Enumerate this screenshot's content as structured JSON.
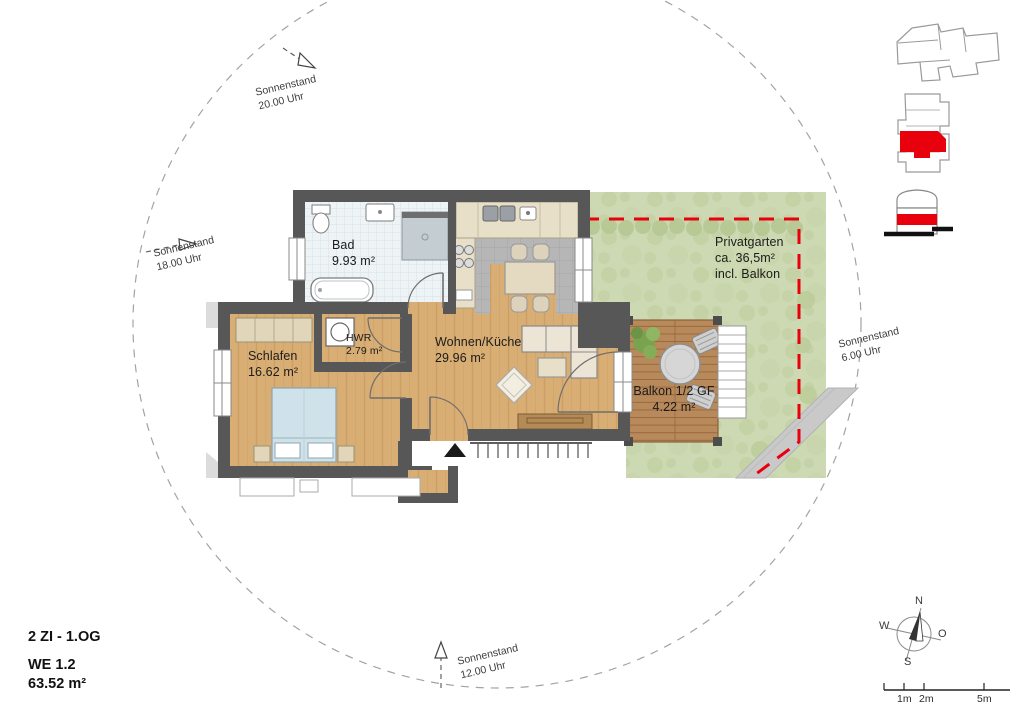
{
  "title_block": {
    "type_line": "2 ZI - 1.OG",
    "unit_line": "WE 1.2",
    "area_line": "63.52 m²"
  },
  "rooms": {
    "bad": {
      "name": "Bad",
      "area": "9.93 m²"
    },
    "schlafen": {
      "name": "Schlafen",
      "area": "16.62 m²"
    },
    "hwr": {
      "name": "HWR",
      "area": "2.79 m²"
    },
    "wohnen": {
      "name": "Wohnen/Küche",
      "area": "29.96 m²"
    },
    "balkon": {
      "name": "Balkon 1/2 GF",
      "area": "4.22 m²"
    },
    "privatgarten": {
      "name": "Privatgarten",
      "area": "ca. 36,5m²",
      "note": "incl. Balkon"
    }
  },
  "sun_positions": {
    "s2000": {
      "label": "Sonnenstand",
      "time": "20.00 Uhr"
    },
    "s1800": {
      "label": "Sonnenstand",
      "time": "18.00 Uhr"
    },
    "s0600": {
      "label": "Sonnenstand",
      "time": "6.00 Uhr"
    },
    "s1200": {
      "label": "Sonnenstand",
      "time": "12.00 Uhr"
    }
  },
  "compass": {
    "north": "N",
    "east": "O",
    "south": "S",
    "west": "W"
  },
  "scale_bar": {
    "tick_1": "1m",
    "tick_2": "2m",
    "tick_3": "5m"
  },
  "colors": {
    "highlight_red": "#e8000d",
    "wall_gray": "#575757",
    "wood": "#d9ae74",
    "garden_green": "#cdd9b2",
    "deck_brown": "#b8895a",
    "tile_blue": "#eef3f6"
  }
}
